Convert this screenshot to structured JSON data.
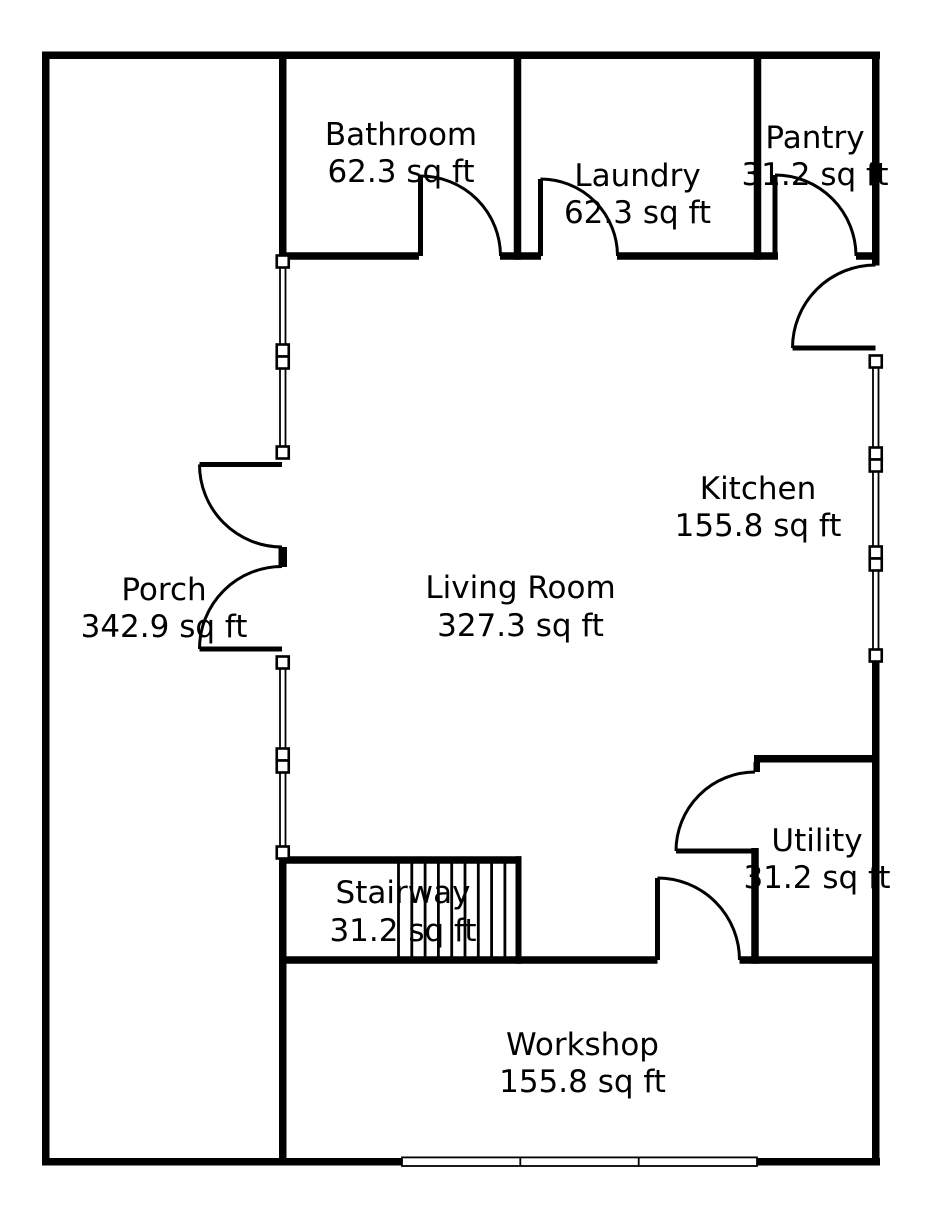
{
  "colors": {
    "wall": "#000000",
    "background": "#ffffff",
    "text": "#000000"
  },
  "units": "sq ft",
  "rooms": [
    {
      "name": "Bathroom",
      "area": "62.3 sq ft"
    },
    {
      "name": "Laundry",
      "area": "62.3 sq ft"
    },
    {
      "name": "Pantry",
      "area": "31.2 sq ft"
    },
    {
      "name": "Kitchen",
      "area": "155.8 sq ft"
    },
    {
      "name": "Living Room",
      "area": "327.3 sq ft"
    },
    {
      "name": "Porch",
      "area": "342.9 sq ft"
    },
    {
      "name": "Stairway",
      "area": "31.2 sq ft"
    },
    {
      "name": "Utility",
      "area": "31.2 sq ft"
    },
    {
      "name": "Workshop",
      "area": "155.8 sq ft"
    }
  ]
}
